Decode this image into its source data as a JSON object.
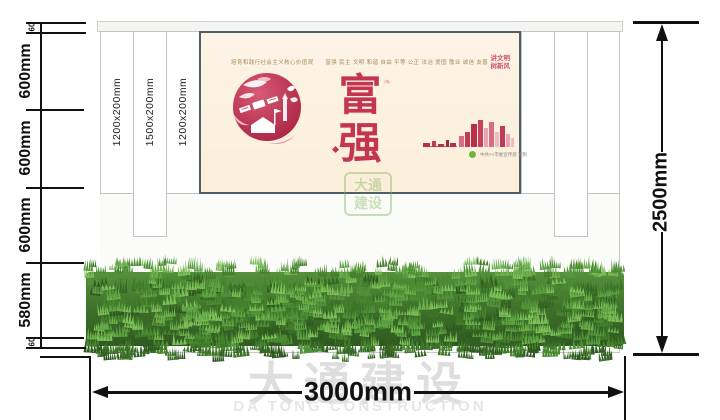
{
  "dims": {
    "left_segments": [
      "60",
      "600mm",
      "600mm",
      "600mm",
      "580mm",
      "60"
    ],
    "right_total": "2500mm",
    "bottom_total": "3000mm"
  },
  "slats": {
    "labels": [
      "1200x200mm",
      "1500x200mm",
      "1200x200mm"
    ]
  },
  "poster": {
    "values_line": "培育和践行社会主义核心价值观　　富强 民主 文明 和谐 自由 平等 公正 法治 爱国 敬业 诚信 友善",
    "char_top": "富",
    "char_bottom": "强",
    "slogan_line1": "讲文明",
    "slogan_line2": "树新风",
    "credit": "中共××市委宣传部 宣制"
  },
  "watermark": {
    "cn": "大通建设",
    "en": "DA TONG CONSTRUCTION",
    "logo_line1": "大通",
    "logo_line2": "建设"
  },
  "colors": {
    "poster_red": "#c43552",
    "poster_bg": "#fdf3e5",
    "poster_frame": "#4e5f66",
    "grass_green": "#4a8a31",
    "dimension_black": "#111111",
    "watermark_gray": "#dedede"
  }
}
